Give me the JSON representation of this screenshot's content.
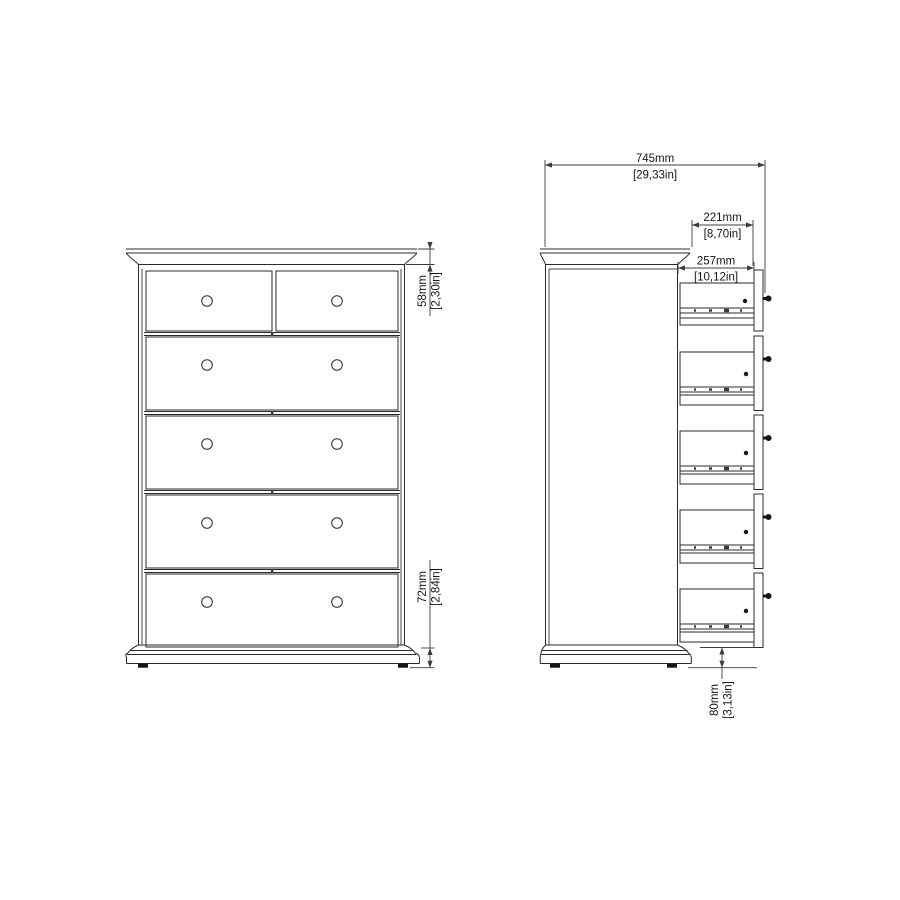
{
  "drawing": {
    "background": "#ffffff",
    "line_color": "#2b2b2b",
    "dimension_color": "#3c3c3c",
    "front_view": {
      "description": "front elevation of chest, 2 small top drawers + 4 wide drawers, round knobs",
      "drawer_rows": 5,
      "top_row_drawer_count": 2,
      "knob_count": 10,
      "dim_crown": {
        "mm": "58mm",
        "inch": "[2,30in]"
      },
      "dim_base": {
        "mm": "72mm",
        "inch": "[2,84in]"
      }
    },
    "side_view": {
      "description": "side elevation with 5 drawers extended on slides",
      "extended_drawers": 5,
      "dim_total_depth": {
        "mm": "745mm",
        "inch": "[29,33in]"
      },
      "dim_drawer_extension": {
        "mm": "221mm",
        "inch": "[8,70in]"
      },
      "dim_drawer_depth": {
        "mm": "257mm",
        "inch": "[10,12in]"
      },
      "dim_base_height": {
        "mm": "80mm",
        "inch": "[3,13in]"
      }
    }
  }
}
